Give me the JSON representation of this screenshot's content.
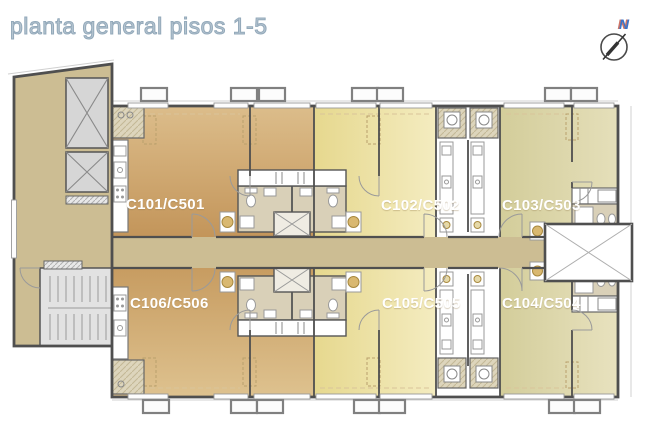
{
  "title": "planta general pisos 1-5",
  "compass": {
    "label": "N"
  },
  "apartments": [
    {
      "id": "C101",
      "label": "C101/C501",
      "color_dark": "#c3955a",
      "color_light": "#dcbd8b"
    },
    {
      "id": "C102",
      "label": "C102/C502",
      "color_dark": "#e6d88e",
      "color_light": "#f4ecc0"
    },
    {
      "id": "C103",
      "label": "C103/C503",
      "color_dark": "#d3cd9a",
      "color_light": "#e5dfba"
    },
    {
      "id": "C104",
      "label": "C104/C504",
      "color_dark": "#d3cd9a",
      "color_light": "#e8e2bf"
    },
    {
      "id": "C105",
      "label": "C105/C505",
      "color_dark": "#e6d88e",
      "color_light": "#f4ecc0"
    },
    {
      "id": "C106",
      "label": "C106/C506",
      "color_dark": "#c79c61",
      "color_light": "#dec28f"
    }
  ],
  "colors": {
    "corridor": "#ccbd93",
    "bath_floor": "#d9d0b8",
    "pantry_hatch": "#ddd5bc",
    "wall": "#4f4f4f",
    "shaft_gray": "#d6d6d6",
    "stair_gray": "#e2e2e2",
    "void_x": "#aeaeae",
    "title_text": "#9db1c1",
    "north_text": "#3b74c9",
    "apartment_label_text": "#ffffff"
  }
}
